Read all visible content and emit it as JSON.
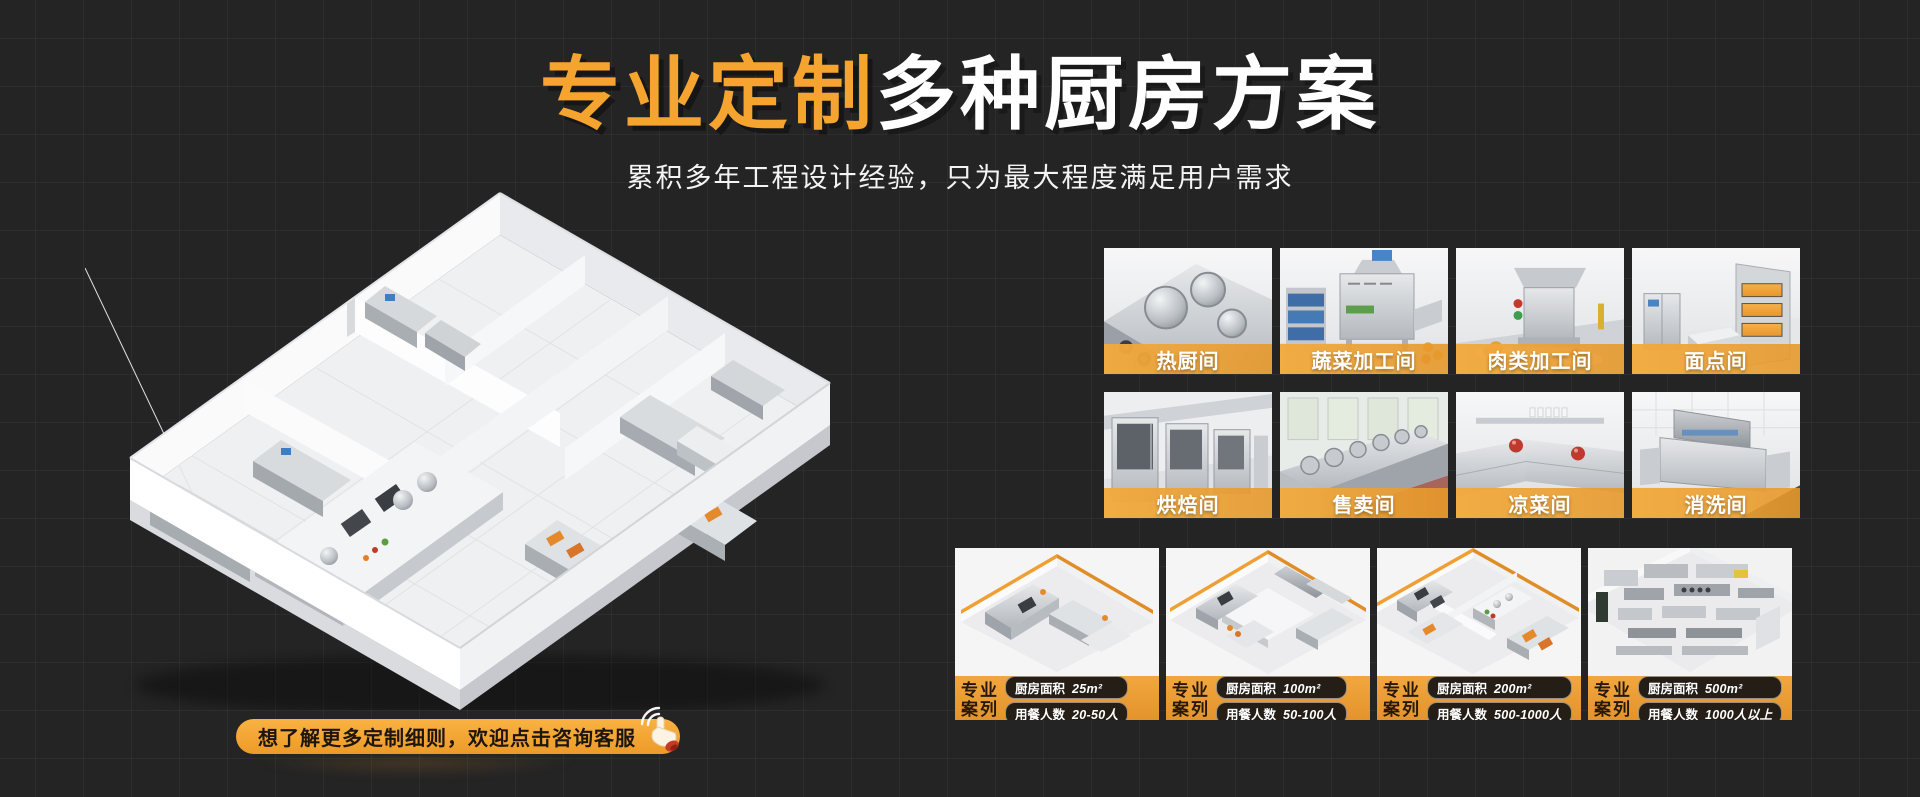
{
  "theme": {
    "background": "#242424",
    "accent_orange": "#F5A52F",
    "band_orange": "#E9A33C",
    "footer_orange": "#EC9F35",
    "pill_dark": "#241E17",
    "text_white": "#FFFFFF"
  },
  "header": {
    "title_highlight": "专业定制",
    "title_rest": "多种厨房方案",
    "subtitle": "累积多年工程设计经验，只为最大程度满足用户需求"
  },
  "rooms": {
    "items": [
      {
        "label": "热厨间",
        "icon": "hot-kitchen-photo"
      },
      {
        "label": "蔬菜加工间",
        "icon": "vegetable-processing-photo"
      },
      {
        "label": "肉类加工间",
        "icon": "meat-processing-photo"
      },
      {
        "label": "面点间",
        "icon": "pastry-room-photo"
      },
      {
        "label": "烘焙间",
        "icon": "baking-room-photo"
      },
      {
        "label": "售卖间",
        "icon": "serving-room-photo"
      },
      {
        "label": "凉菜间",
        "icon": "cold-dish-room-photo"
      },
      {
        "label": "消洗间",
        "icon": "dishwashing-room-photo"
      }
    ]
  },
  "cases": {
    "badge_line1": "专业",
    "badge_line2": "案列",
    "area_label": "厨房面积",
    "diners_label": "用餐人数",
    "items": [
      {
        "area": "25m²",
        "diners": "20-50人"
      },
      {
        "area": "100m²",
        "diners": "50-100人"
      },
      {
        "area": "200m²",
        "diners": "500-1000人"
      },
      {
        "area": "500m²",
        "diners": "1000人以上"
      }
    ]
  },
  "cta": {
    "label": "想了解更多定制细则，欢迎点击咨询客服"
  }
}
